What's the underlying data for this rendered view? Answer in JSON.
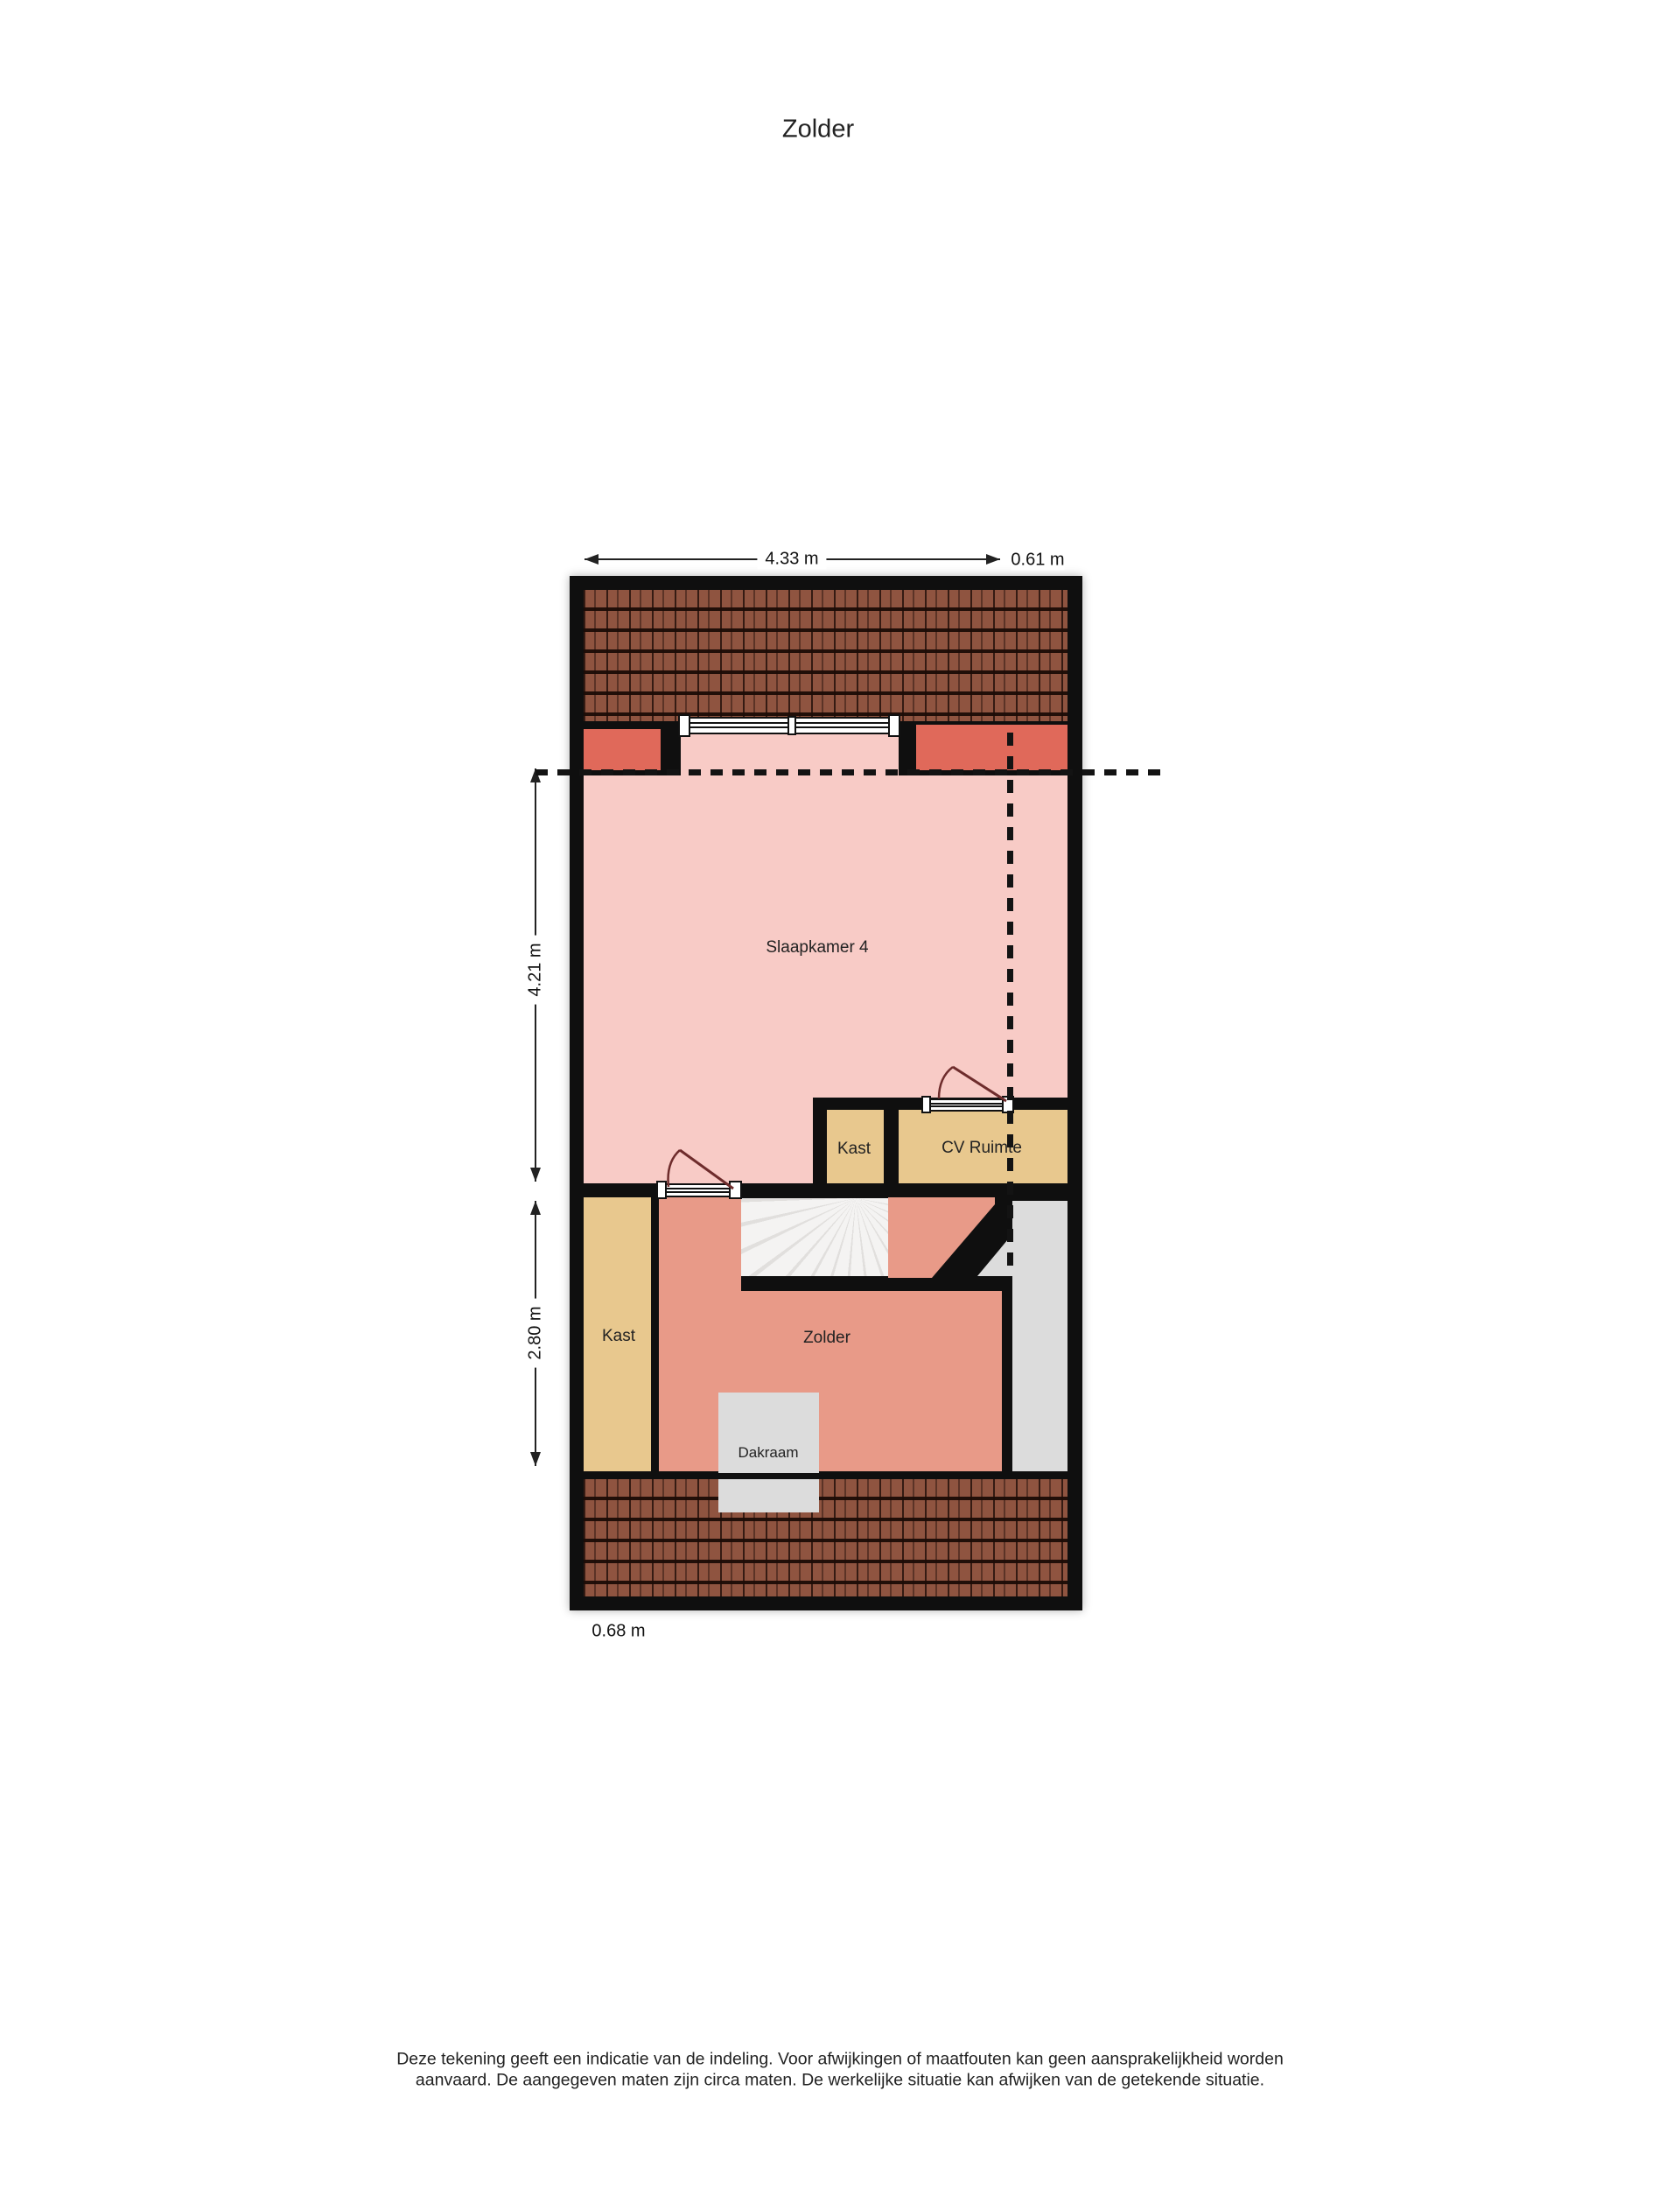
{
  "title": "Zolder",
  "floorplan": {
    "dimensions": {
      "top_width": "4.33 m",
      "top_extension": "0.61 m",
      "left_upper_height": "4.21 m",
      "left_lower_height": "2.80 m",
      "bottom_offset": "0.68 m"
    },
    "rooms": {
      "slaapkamer": "Slaapkamer 4",
      "kast_upper": "Kast",
      "cv_ruimte": "CV Ruimte",
      "kast_lower": "Kast",
      "zolder": "Zolder",
      "dakraam": "Dakraam"
    }
  },
  "disclaimer": {
    "line1": "Deze tekening geeft een indicatie van de indeling. Voor afwijkingen of maatfouten kan geen aansprakelijkheid worden",
    "line2": "aanvaard. De aangegeven maten zijn circa maten. De werkelijke situatie kan afwijken van de getekende situatie."
  },
  "colors": {
    "wall": "#0f0f0f",
    "bedroom_fill": "#f8cbc6",
    "attic_fill": "#e89a88",
    "dormer_fill": "#e0695a",
    "closet_fill": "#e8c88e",
    "void_fill": "#dcdcdc",
    "roof_tile": "#8f5440",
    "door_swing": "#6e2c2c"
  }
}
